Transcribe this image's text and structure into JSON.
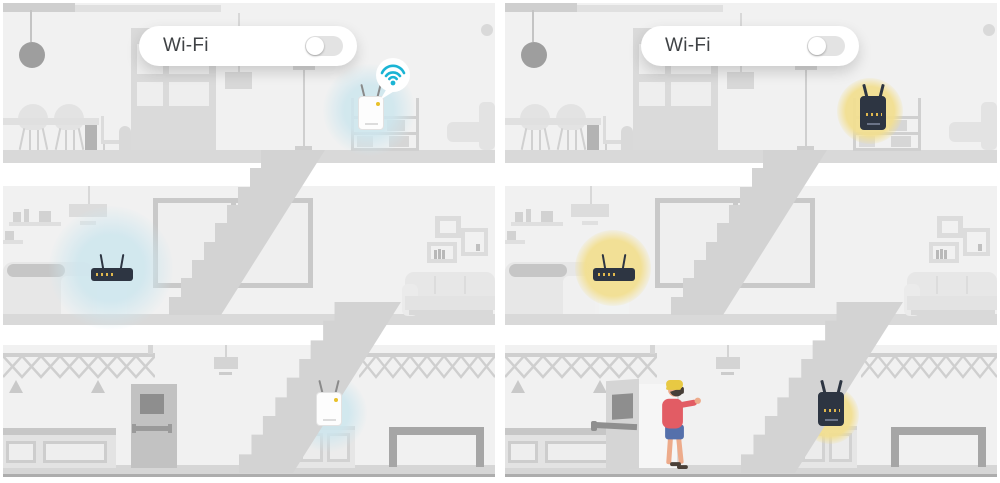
{
  "title": "Wi-Fi extender home coverage illustration, before and after comparison",
  "theme": {
    "page_bg": "#ffffff",
    "room_bg": "#f1f1f1",
    "slab": "#d9d9d9",
    "stairs": "#d3d3d3",
    "furn_light": "#e3e3e3",
    "furn_mid": "#d2d2d2",
    "furn_dark": "#b3b3b3",
    "metal": "#9a9a9a",
    "device_dark": "#2d3542",
    "accent_teal": "#1ab4d4",
    "glow_blue": "#cde6ee",
    "glow_yellow": "#f2df91",
    "baseline": "#adadad",
    "text": "#3f4245",
    "toggle_track": "#e3e3e3",
    "toggle_knob": "#ffffff",
    "door": "#c2c2c2",
    "door_pane": "#8e8e8e",
    "person_jacket": "#e25c64",
    "person_shorts": "#5570ab",
    "person_skin": "#edab8b",
    "person_hat": "#e8c943",
    "person_hair": "#473f38",
    "person_shoe": "#4a4038"
  },
  "scene": {
    "floors": [
      "upper floor: dining table, chairs, pendant lamp, partition window, shelf unit, armchair",
      "middle floor: wall shelves, pendant lamp, daybed, router on stand, large window, picture frames, sofa",
      "basement: ceiling trusses, pendant lamp, entry door, counter, cabinet, work table, staircase"
    ]
  },
  "panels": [
    {
      "name": "before",
      "wifi_toggle": {
        "label": "Wi-Fi",
        "state": "off"
      },
      "glow_style": "blue",
      "glow_color": "#cde6ee",
      "callout_icon": "wifi-signal-icon",
      "devices": [
        {
          "type": "range-extender",
          "location": "upper-floor shelf",
          "style": "white",
          "status_led": "yellow"
        },
        {
          "type": "router",
          "location": "middle-floor stand",
          "style": "dark"
        },
        {
          "type": "range-extender",
          "location": "basement cabinet",
          "style": "white"
        }
      ],
      "person_visible": false
    },
    {
      "name": "after",
      "wifi_toggle": {
        "label": "Wi-Fi",
        "state": "off"
      },
      "glow_style": "yellow",
      "glow_color": "#f2df91",
      "callout_icon": null,
      "devices": [
        {
          "type": "range-extender",
          "location": "upper-floor shelf",
          "style": "dark"
        },
        {
          "type": "router",
          "location": "middle-floor stand",
          "style": "dark"
        },
        {
          "type": "range-extender",
          "location": "basement cabinet",
          "style": "dark"
        }
      ],
      "person_visible": true,
      "person": {
        "description": "person in yellow beanie, red jacket, blue shorts entering through open basement door"
      }
    }
  ]
}
